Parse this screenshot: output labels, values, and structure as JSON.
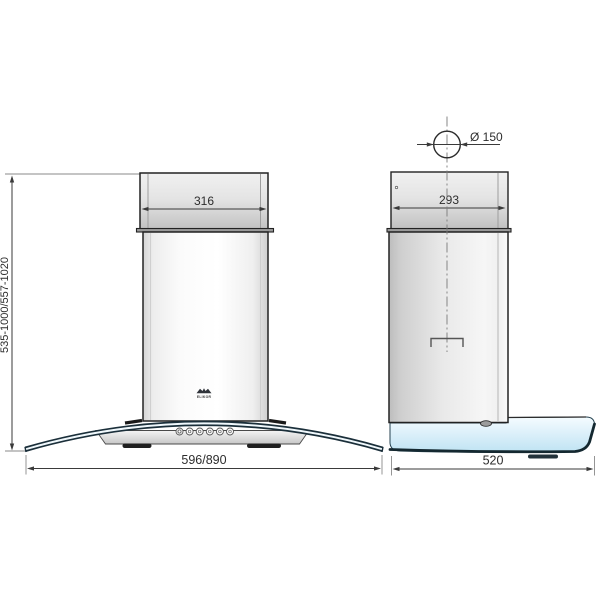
{
  "brand": "ELIKOR",
  "dimensions": {
    "chimney_width_front": "316",
    "chimney_depth_side": "293",
    "duct_diameter": "Ø 150",
    "height_range": "535-1000/557-1020",
    "body_width": "596/890",
    "body_depth": "520"
  },
  "colors": {
    "outline": "#222222",
    "dimension_text": "#2d2d2d",
    "extension_line": "#8a8a8a",
    "glass_blue_light": "#f5fcff",
    "glass_blue_dark": "#bfe3f3",
    "glass_edge": "#142830",
    "metal_light": "#fbfbfb",
    "metal_dark": "#c0c0c0"
  }
}
